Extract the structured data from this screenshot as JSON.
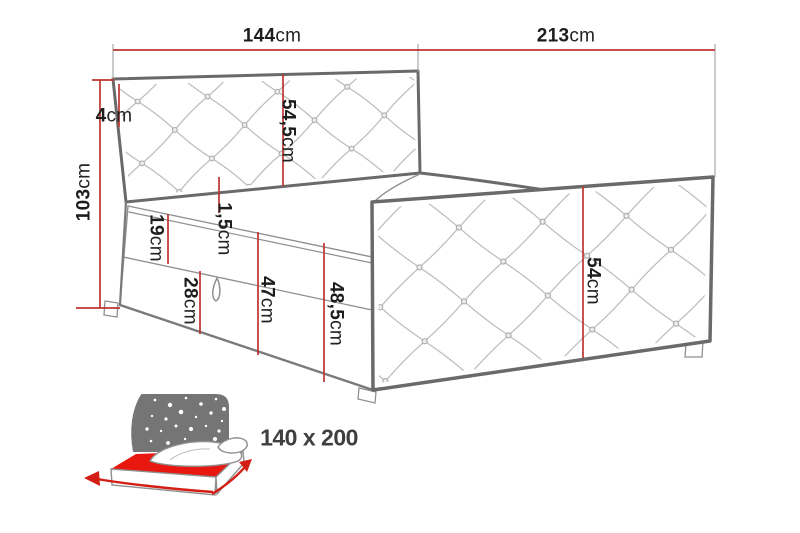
{
  "diagram": {
    "type": "furniture-dimension-diagram",
    "product": "upholstered-bed-with-storage",
    "labels": {
      "width_top": {
        "value": "144",
        "unit": "cm"
      },
      "length_side": {
        "value": "213",
        "unit": "cm"
      },
      "height_total": {
        "value": "103",
        "unit": "cm"
      },
      "headboard_frame": {
        "value": "4",
        "unit": "cm"
      },
      "headboard_inner": {
        "value": "54,5",
        "unit": "cm"
      },
      "platform_lip": {
        "value": "1,5",
        "unit": "cm"
      },
      "mattress": {
        "value": "19",
        "unit": "cm"
      },
      "drawer": {
        "value": "28",
        "unit": "cm"
      },
      "base_front": {
        "value": "47",
        "unit": "cm"
      },
      "base_total": {
        "value": "48,5",
        "unit": "cm"
      },
      "side_panel": {
        "value": "54",
        "unit": "cm"
      }
    },
    "size_badge": "140 x 200",
    "colors": {
      "dimension_line": "#bf3430",
      "drawing_outline": "#6a6a6a",
      "lattice": "#b3b3b3",
      "icon_red": "#e8170f",
      "icon_gray": "#757575",
      "text": "#1d1d1d"
    }
  }
}
